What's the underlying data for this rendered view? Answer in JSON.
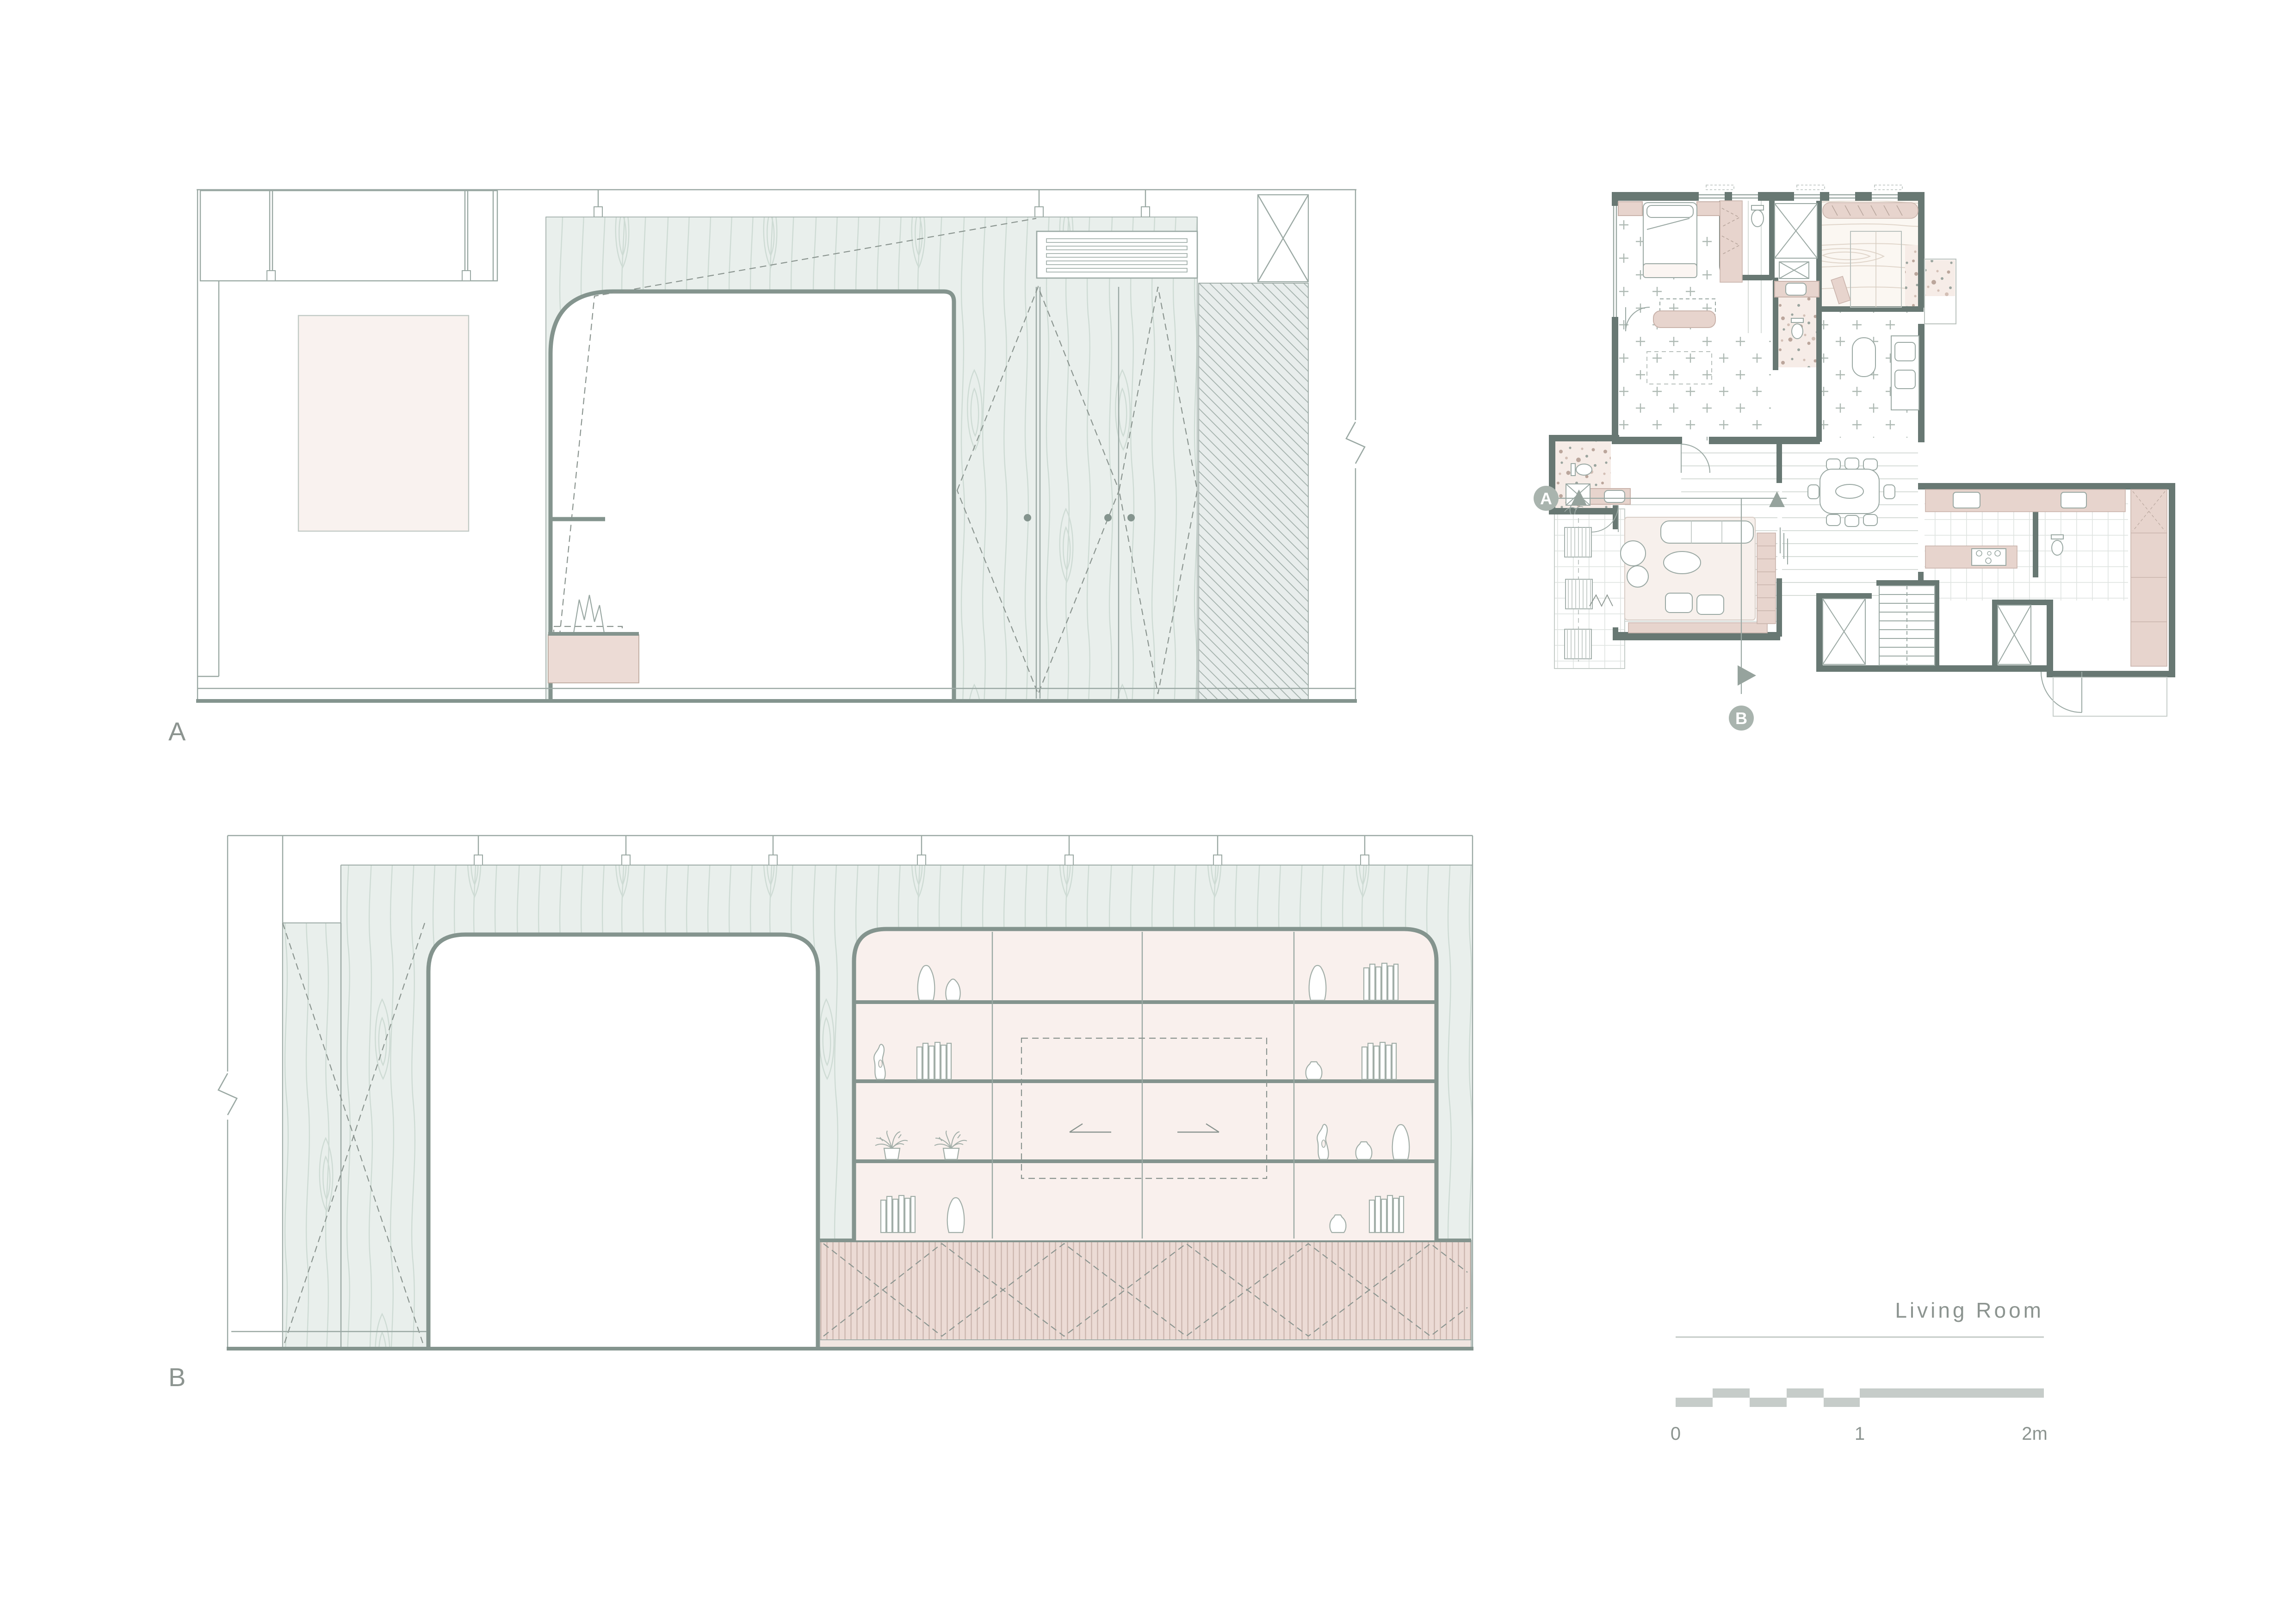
{
  "document": {
    "kind": "architectural interior drawing",
    "room_name": "Living Room"
  },
  "elevations": {
    "a": {
      "label": "A"
    },
    "b": {
      "label": "B"
    }
  },
  "floor_plan": {
    "marker_a": "A",
    "marker_b": "B"
  },
  "title_block": {
    "title": "Living Room",
    "scale_ticks": [
      "0",
      "1",
      "2m"
    ]
  },
  "colors": {
    "wall_dark": "#687873",
    "outline_thick": "#84948e",
    "outline_thin": "#9aa8a3",
    "wood_mint": "#e9efec",
    "wood_grain": "#c7d6cf",
    "shelf_pink": "#f9f0ed",
    "cabinet_pink": "#ecdbd5",
    "hatch_bg": "#e8edec",
    "label_gray": "#8c9490",
    "marker_gray": "#a9b4ae"
  }
}
